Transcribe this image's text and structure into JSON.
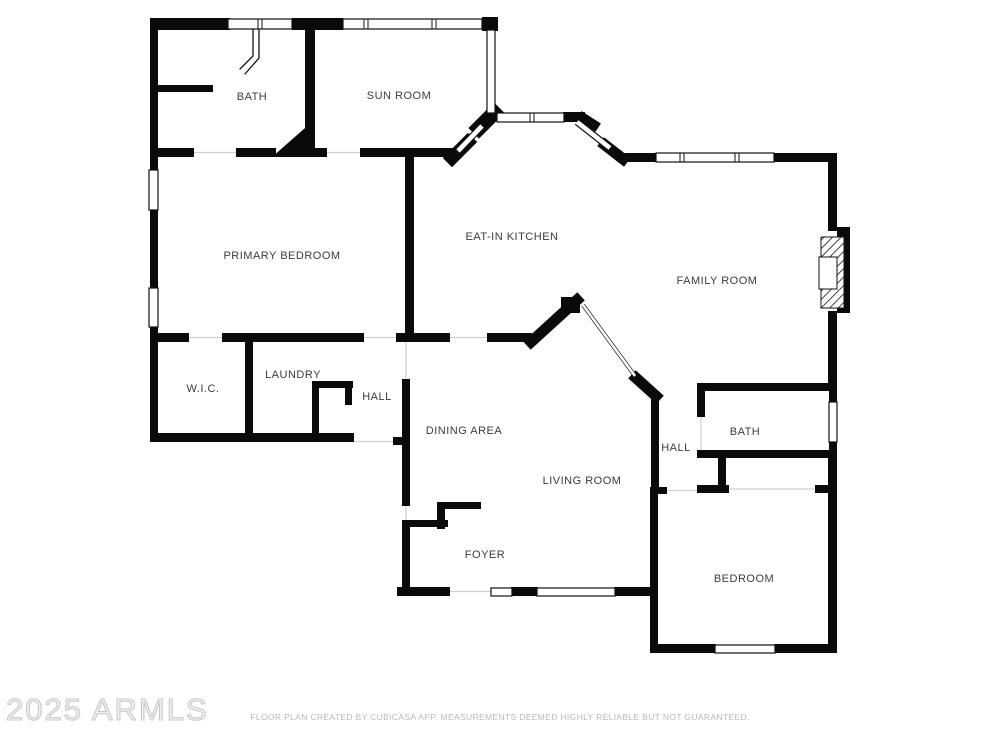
{
  "watermark": "2025 ARMLS",
  "footer": "FLOOR PLAN CREATED BY CUBICASA APP. MEASUREMENTS DEEMED HIGHLY RELIABLE BUT NOT GUARANTEED.",
  "colors": {
    "wall": "#0a0a0a",
    "window_line": "#111111",
    "label": "#3b3b3b",
    "opening": "#cfcfcf",
    "footer_text": "#b9b9b9",
    "watermark_text": "#c9c9c9"
  },
  "rooms": [
    {
      "id": "bath-1",
      "label": "BATH",
      "x": 252,
      "y": 97
    },
    {
      "id": "sun-room",
      "label": "SUN ROOM",
      "x": 399,
      "y": 96
    },
    {
      "id": "primary-bedroom",
      "label": "PRIMARY BEDROOM",
      "x": 282,
      "y": 256
    },
    {
      "id": "eat-in-kitchen",
      "label": "EAT-IN KITCHEN",
      "x": 512,
      "y": 237
    },
    {
      "id": "family-room",
      "label": "FAMILY ROOM",
      "x": 717,
      "y": 281
    },
    {
      "id": "wic",
      "label": "W.I.C.",
      "x": 203,
      "y": 389
    },
    {
      "id": "laundry",
      "label": "LAUNDRY",
      "x": 293,
      "y": 375
    },
    {
      "id": "hall-1",
      "label": "HALL",
      "x": 377,
      "y": 397
    },
    {
      "id": "dining-area",
      "label": "DINING AREA",
      "x": 464,
      "y": 431
    },
    {
      "id": "living-room",
      "label": "LIVING ROOM",
      "x": 582,
      "y": 481
    },
    {
      "id": "hall-2",
      "label": "HALL",
      "x": 676,
      "y": 448
    },
    {
      "id": "bath-2",
      "label": "BATH",
      "x": 745,
      "y": 432
    },
    {
      "id": "foyer",
      "label": "FOYER",
      "x": 485,
      "y": 555
    },
    {
      "id": "bedroom",
      "label": "BEDROOM",
      "x": 744,
      "y": 579
    }
  ],
  "plan": {
    "walls_rect": [
      [
        150,
        18,
        80,
        12
      ],
      [
        292,
        18,
        24,
        12
      ],
      [
        316,
        18,
        27,
        12
      ],
      [
        482,
        17,
        16,
        14
      ],
      [
        150,
        18,
        8,
        152
      ],
      [
        150,
        210,
        8,
        78
      ],
      [
        150,
        327,
        8,
        115
      ],
      [
        157,
        85,
        56,
        7
      ],
      [
        305,
        18,
        10,
        139
      ],
      [
        150,
        148,
        44,
        9
      ],
      [
        236,
        148,
        40,
        9
      ],
      [
        310,
        148,
        17,
        9
      ],
      [
        360,
        148,
        101,
        9
      ],
      [
        618,
        153,
        39,
        9
      ],
      [
        774,
        153,
        63,
        9
      ],
      [
        828,
        153,
        9,
        78
      ],
      [
        837,
        227,
        13,
        86
      ],
      [
        828,
        311,
        9,
        74
      ],
      [
        697,
        383,
        140,
        8
      ],
      [
        829,
        383,
        8,
        20
      ],
      [
        829,
        441,
        8,
        16
      ],
      [
        828,
        450,
        9,
        203
      ],
      [
        653,
        644,
        63,
        9
      ],
      [
        774,
        644,
        63,
        9
      ],
      [
        650,
        487,
        8,
        166
      ],
      [
        650,
        487,
        17,
        7
      ],
      [
        697,
        485,
        32,
        8
      ],
      [
        815,
        485,
        22,
        8
      ],
      [
        718,
        452,
        8,
        39
      ],
      [
        697,
        383,
        8,
        34
      ],
      [
        697,
        450,
        134,
        8
      ],
      [
        651,
        391,
        8,
        100
      ],
      [
        405,
        155,
        9,
        187
      ],
      [
        487,
        333,
        45,
        9
      ],
      [
        410,
        333,
        40,
        9
      ],
      [
        396,
        333,
        15,
        9
      ],
      [
        222,
        333,
        142,
        9
      ],
      [
        150,
        333,
        39,
        9
      ],
      [
        245,
        337,
        8,
        102
      ],
      [
        150,
        433,
        204,
        9
      ],
      [
        393,
        437,
        10,
        8
      ],
      [
        402,
        379,
        8,
        127
      ],
      [
        402,
        520,
        8,
        76
      ],
      [
        437,
        502,
        44,
        7
      ],
      [
        437,
        502,
        8,
        27
      ],
      [
        404,
        520,
        44,
        7
      ],
      [
        312,
        381,
        41,
        7
      ],
      [
        312,
        381,
        7,
        59
      ],
      [
        345,
        381,
        7,
        24
      ],
      [
        397,
        587,
        53,
        9
      ],
      [
        511,
        587,
        27,
        9
      ],
      [
        614,
        587,
        44,
        9
      ],
      [
        561,
        297,
        19,
        16
      ],
      [
        563,
        112,
        22,
        10
      ]
    ],
    "walls_line": [
      [
        452,
        158,
        468,
        142,
        13
      ],
      [
        479,
        128,
        494,
        113,
        15
      ],
      [
        583,
        118,
        594,
        125,
        10
      ],
      [
        605,
        145,
        623,
        159,
        11
      ],
      [
        531,
        342,
        577,
        300,
        11
      ],
      [
        636,
        378,
        656,
        396,
        11
      ]
    ],
    "polygons": [
      "272,157 313,157 313,121"
    ],
    "windows_rect": [
      [
        228,
        19,
        64,
        10
      ],
      [
        343,
        19,
        139,
        10
      ],
      [
        149,
        170,
        9,
        40
      ],
      [
        149,
        288,
        9,
        39
      ],
      [
        487,
        30,
        8,
        83
      ],
      [
        497,
        113,
        67,
        9
      ],
      [
        656,
        153,
        118,
        9
      ],
      [
        829,
        402,
        8,
        40
      ],
      [
        715,
        645,
        60,
        8
      ],
      [
        491,
        588,
        21,
        8
      ],
      [
        537,
        588,
        78,
        8
      ]
    ],
    "mullions": [
      [
        260,
        19,
        10
      ],
      [
        366,
        19,
        10
      ],
      [
        434,
        19,
        10
      ],
      [
        532,
        113,
        9
      ],
      [
        682,
        153,
        9
      ],
      [
        737,
        153,
        9
      ]
    ],
    "windows_diag": [
      [
        458,
        151,
        482,
        126
      ],
      [
        577,
        122,
        610,
        148
      ]
    ],
    "openings_diag": [
      [
        583,
        305,
        635,
        376
      ]
    ],
    "openings": [
      [
        194,
        152.5,
        236,
        152.5
      ],
      [
        327,
        152.5,
        360,
        152.5
      ],
      [
        188,
        337.5,
        222,
        337.5
      ],
      [
        364,
        337.5,
        396,
        337.5
      ],
      [
        450,
        337.5,
        487,
        337.5
      ],
      [
        406,
        341,
        406,
        379
      ],
      [
        354,
        441.5,
        393,
        441.5
      ],
      [
        406,
        506,
        406,
        520
      ],
      [
        449,
        591.5,
        491,
        591.5
      ],
      [
        667,
        490.5,
        697,
        490.5
      ],
      [
        701,
        417,
        701,
        450
      ],
      [
        729,
        489,
        815,
        489
      ]
    ],
    "shower_paths": [
      "M253,30 L253,56 L240,69",
      "M259,30 L259,58 L245,74"
    ],
    "fireplace": {
      "hatch_rect": [
        821,
        237,
        23,
        71
      ],
      "inner_rect": [
        819,
        257,
        18,
        32
      ]
    }
  }
}
